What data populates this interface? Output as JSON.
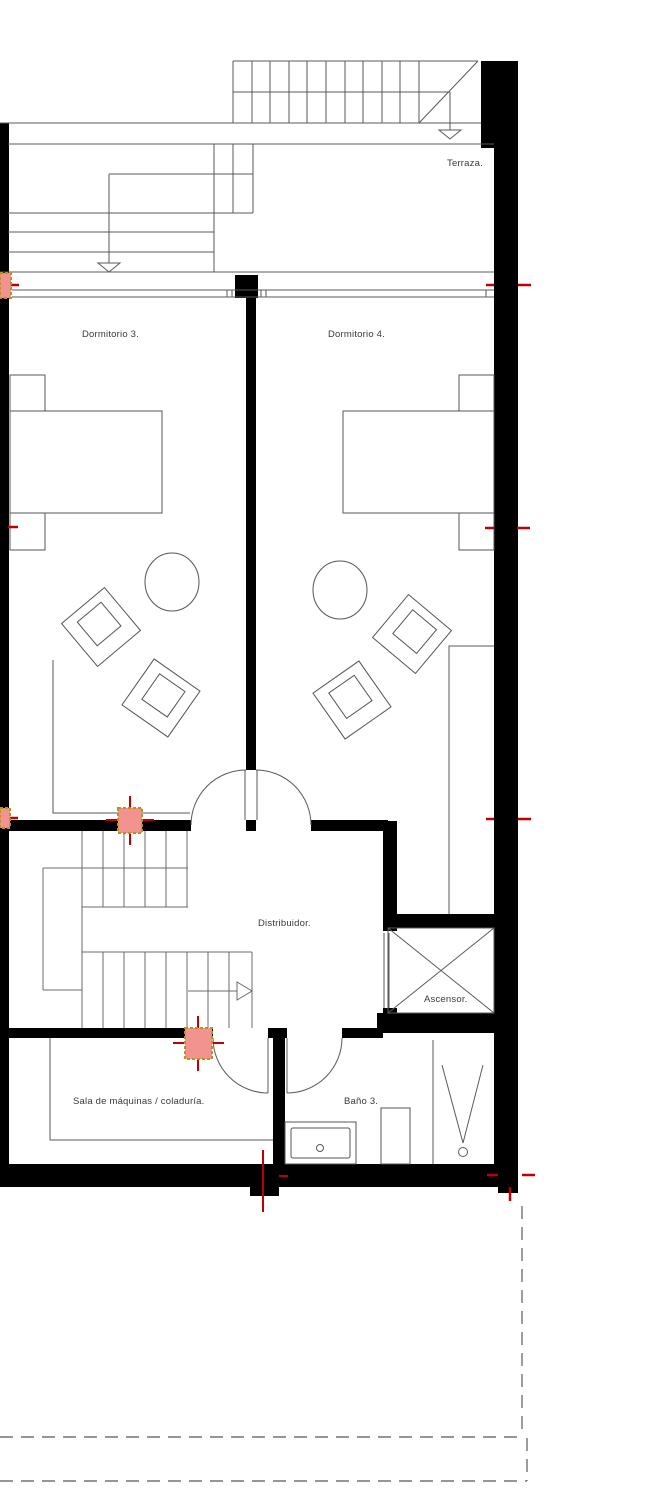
{
  "plan": {
    "title": "floor-plan",
    "rooms": {
      "terraza": "Terraza.",
      "dormitorio3": "Dormitorio 3.",
      "dormitorio4": "Dormitorio 4.",
      "distribuidor": "Distribuidor.",
      "ascensor": "Ascensor.",
      "sala_maquinas": "Sala de máquinas / coladuría.",
      "bano3": "Baño 3."
    },
    "symbols": {
      "stair_direction_arrows": 3,
      "electrical_markers": 4,
      "survey_tick_color": "#c00000"
    },
    "colors": {
      "wall": "#000000",
      "line": "#5a5a5a",
      "red_tick": "#c00000",
      "marker_fill": "#f2938f",
      "marker_border": "#bc9022",
      "boundary_dashed": "#737373",
      "label_text": "#3a3a3a",
      "background": "#ffffff"
    }
  }
}
